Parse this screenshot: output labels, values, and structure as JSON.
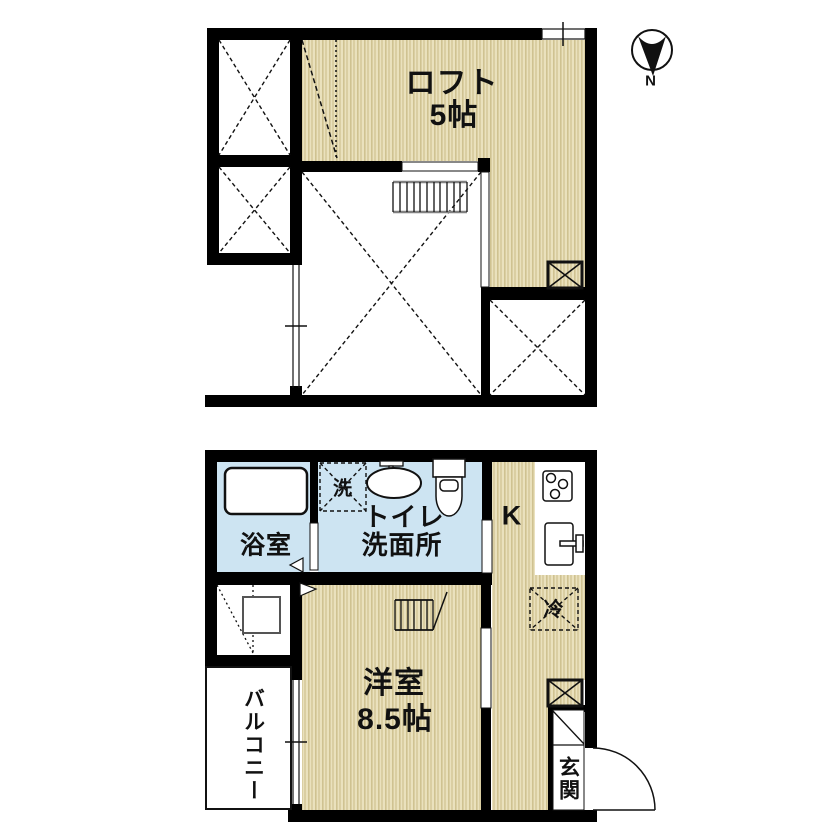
{
  "compass": {
    "label": "N"
  },
  "floor2": {
    "loft": {
      "label": "ロフト",
      "size": "5帖"
    }
  },
  "floor1": {
    "bath": {
      "label": "浴室"
    },
    "laundry": {
      "label": "洗"
    },
    "washroom": {
      "line1": "トイレ",
      "line2": "洗面所"
    },
    "kitchen": {
      "label": "K"
    },
    "fridge": {
      "label": "冷"
    },
    "room": {
      "label": "洋室",
      "size": "8.5帖"
    },
    "balcony": {
      "label": "バルコニー"
    },
    "entrance": {
      "label": "玄関"
    }
  },
  "colors": {
    "wall": "#000000",
    "tatami_base": "#eae1bd",
    "tatami_stripe": "#cfc291",
    "water": "#cde4f2",
    "line_gray": "#808080"
  }
}
